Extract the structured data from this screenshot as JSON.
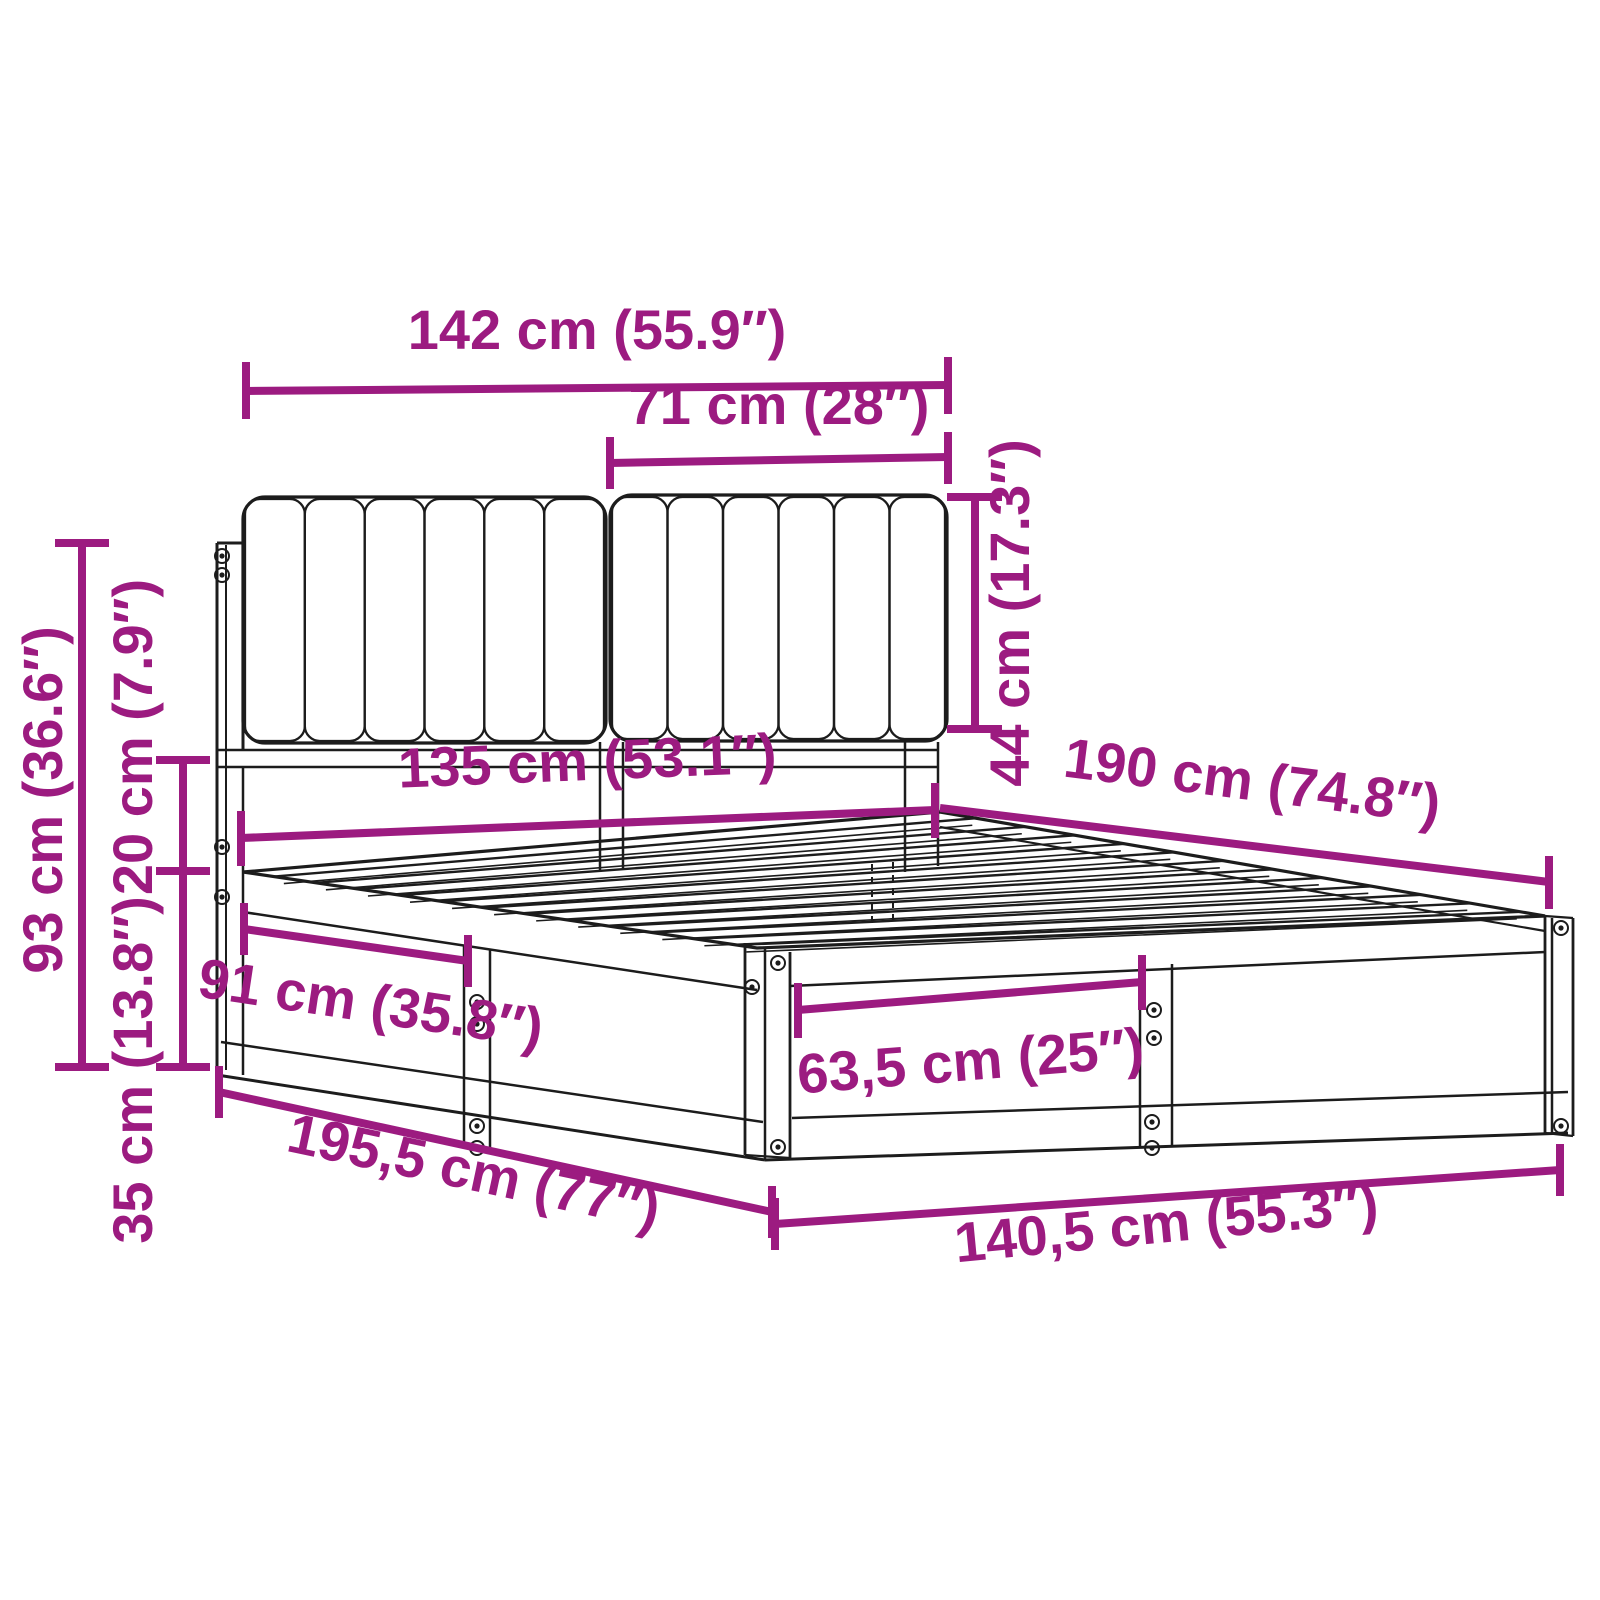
{
  "diagram": {
    "title": "bed-frame-with-upholstered-headboard-dimension-diagram",
    "background_color": "#ffffff",
    "accent_color": "#9C1B80",
    "drawing_color": "#1c1c1c",
    "dimensions": {
      "headboard_total_width": "142 cm (55.9″)",
      "headboard_cushion_width": "71 cm (28″)",
      "headboard_cushion_height": "44 cm (17.3″)",
      "headboard_total_height": "93 cm (36.6″)",
      "cushion_to_base_gap": "20 cm (7.9″)",
      "base_frame_height": "35 cm (13.8″)",
      "frame_inner_width": "135 cm (53.1″)",
      "side_panel_length": "91 cm (35.8″)",
      "front_panel_length": "63,5 cm (25″)",
      "mattress_length": "190 cm (74.8″)",
      "total_length": "195,5 cm (77″)",
      "total_width": "140,5 cm (55.3″)"
    }
  }
}
